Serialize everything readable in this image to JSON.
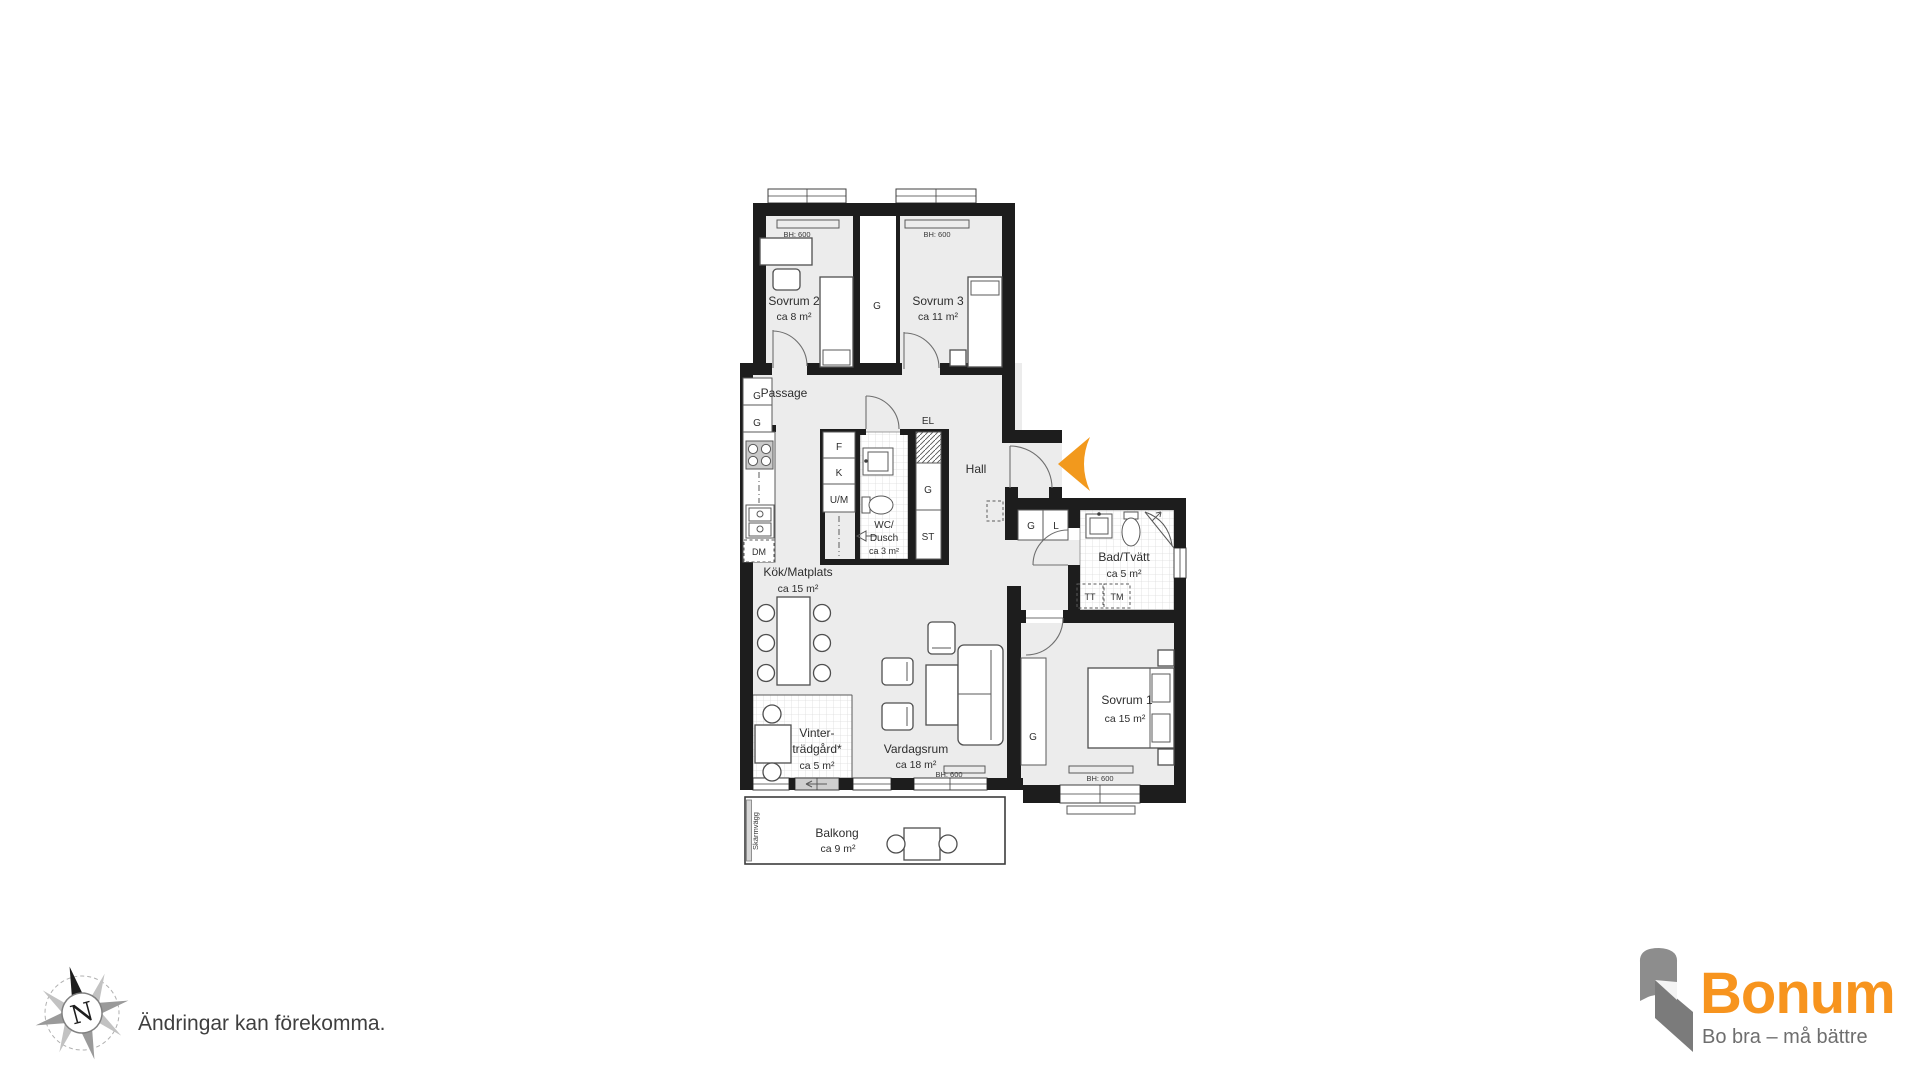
{
  "colors": {
    "wall": "#1d1d1d",
    "room_fill": "#ececec",
    "entry_arrow": "#F2991D",
    "brand_orange": "#F7941E",
    "brand_gray": "#8D8D8D",
    "brand_gray_dark": "#7B7B7B"
  },
  "rooms": {
    "sovrum2": {
      "name": "Sovrum 2",
      "area": "ca 8 m²"
    },
    "sovrum3": {
      "name": "Sovrum 3",
      "area": "ca 11 m²"
    },
    "sovrum1": {
      "name": "Sovrum 1",
      "area": "ca 15 m²"
    },
    "passage": {
      "name": "Passage"
    },
    "hall": {
      "name": "Hall"
    },
    "wc_dusch": {
      "line1": "WC/",
      "line2": "Dusch",
      "area": "ca 3 m²"
    },
    "bad_tvatt": {
      "name": "Bad/Tvätt",
      "area": "ca 5 m²"
    },
    "kok_matplats": {
      "name": "Kök/Matplats",
      "area": "ca 15 m²"
    },
    "vintertradgard": {
      "line1": "Vinter-",
      "line2": "trädgård*",
      "area": "ca 5 m²"
    },
    "vardagsrum": {
      "name": "Vardagsrum",
      "area": "ca 18 m²"
    },
    "balkong": {
      "name": "Balkong",
      "area": "ca 9 m²"
    }
  },
  "fixtures": {
    "garderob": "G",
    "linne": "L",
    "frys": "F",
    "kyl": "K",
    "ugn_micro": "U/M",
    "diskmaskin": "DM",
    "el": "EL",
    "stad": "ST",
    "torktumlare": "TT",
    "tvattmaskin": "TM"
  },
  "labels": {
    "window_head": "BH: 600",
    "screen_wall": "Skärmvägg"
  },
  "compass": {
    "north": "N"
  },
  "note": "Ändringar kan förekomma.",
  "brand": {
    "name": "Bonum",
    "tagline": "Bo bra – må bättre"
  }
}
